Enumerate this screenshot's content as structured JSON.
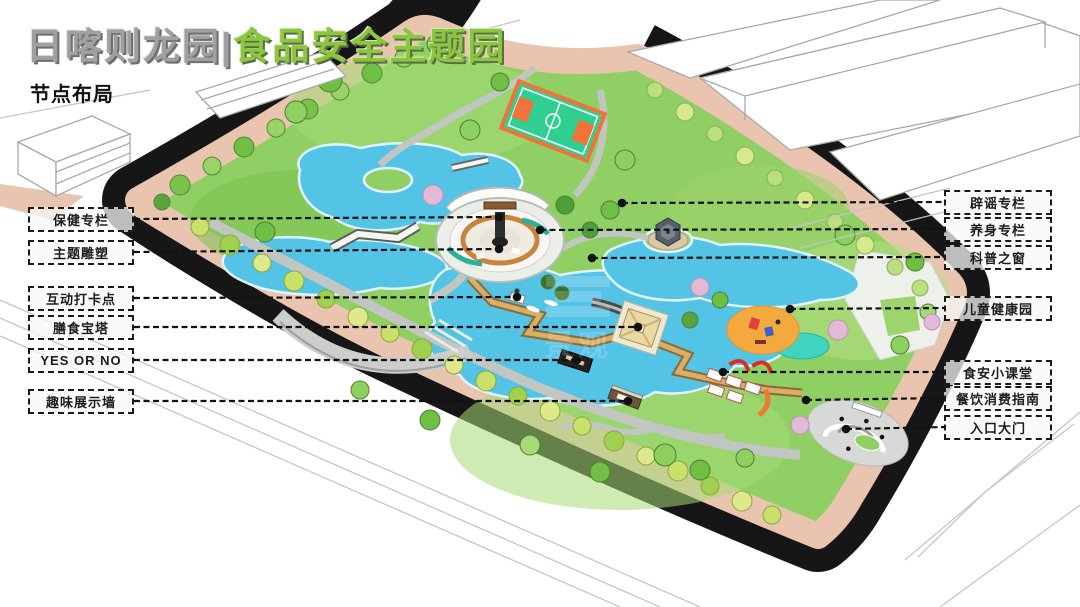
{
  "title": {
    "part_gray": "日喀则龙园|",
    "part_green": "食品安全主题园"
  },
  "subtitle": "节点布局",
  "watermark": "景观",
  "callouts": {
    "left": [
      {
        "label": "保健专栏",
        "y": 219,
        "ex": 499,
        "ey": 217
      },
      {
        "label": "主题雕塑",
        "y": 252,
        "ex": 499,
        "ey": 249
      },
      {
        "label": "互动打卡点",
        "y": 298,
        "ex": 517,
        "ey": 297
      },
      {
        "label": "膳食宝塔",
        "y": 327,
        "ex": 638,
        "ey": 327
      },
      {
        "label": "YES OR NO",
        "y": 360,
        "ex": 577,
        "ey": 360
      },
      {
        "label": "趣味展示墙",
        "y": 401,
        "ex": 628,
        "ey": 401
      }
    ],
    "right": [
      {
        "label": "辟谣专栏",
        "y": 202,
        "ex": 622,
        "ey": 203
      },
      {
        "label": "养身专栏",
        "y": 229,
        "ex": 540,
        "ey": 230
      },
      {
        "label": "科普之窗",
        "y": 257,
        "ex": 592,
        "ey": 258
      },
      {
        "label": "儿童健康园",
        "y": 308,
        "ex": 790,
        "ey": 309
      },
      {
        "label": "食安小课堂",
        "y": 372,
        "ex": 723,
        "ey": 372
      },
      {
        "label": "餐饮消费指南",
        "y": 398,
        "ex": 806,
        "ey": 400
      },
      {
        "label": "入口大门",
        "y": 427,
        "ex": 846,
        "ey": 429
      }
    ]
  },
  "colors": {
    "title_gray": "#a0a0a0",
    "title_green": "#8cc63e",
    "road": "#161616",
    "sidewalk": "#e9c4ae",
    "lawn": "#8fcf63",
    "water": "#53c3e6",
    "court_green": "#2ecf90",
    "court_orange": "#f0743a",
    "playground_orange": "#f4a93e",
    "callout_border": "#1a1a1a"
  }
}
